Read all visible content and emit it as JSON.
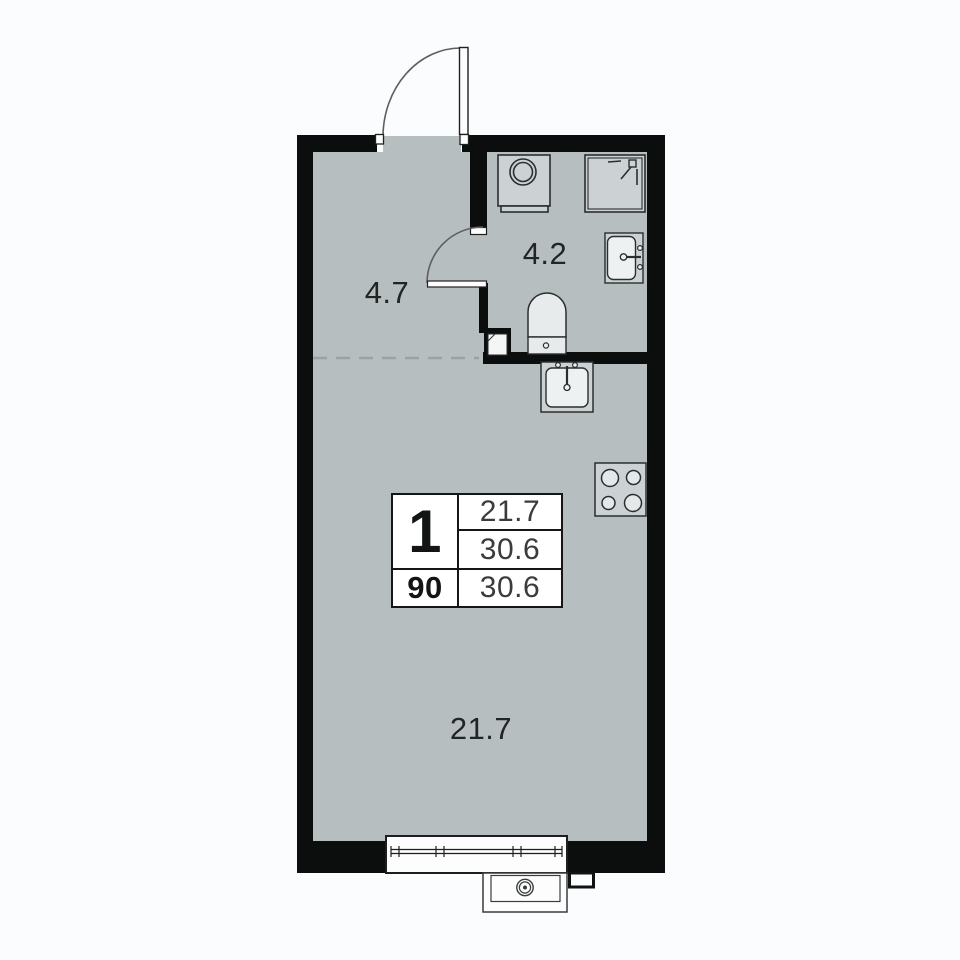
{
  "plan": {
    "type": "studio-apartment-floor-plan",
    "rooms": {
      "hallway": {
        "label": "4.7"
      },
      "bathroom": {
        "label": "4.2"
      },
      "living": {
        "label": "21.7"
      }
    },
    "info_table": {
      "left_top": "1",
      "left_bottom": "90",
      "right": [
        "21.7",
        "30.6",
        "30.6"
      ]
    },
    "fixtures": [
      "entrance-door-icon",
      "interior-door-icon",
      "washing-machine-icon",
      "shower-icon",
      "bathroom-sink-icon",
      "toilet-icon",
      "duct-shaft-icon",
      "kitchen-sink-icon",
      "stove-icon",
      "window-icon",
      "ac-unit-icon",
      "vent-box-icon"
    ],
    "colors": {
      "background": "#fbfcfd",
      "floor": "#b7bec0",
      "wall": "#0c0d0d",
      "fixture_fill": "#ccd2d3",
      "fixture_inner": "#eef1f1",
      "stroke": "#2b2e2e",
      "dashed_line": "#9aa2a4",
      "table_bg": "#ffffff",
      "text": "#232525"
    }
  }
}
